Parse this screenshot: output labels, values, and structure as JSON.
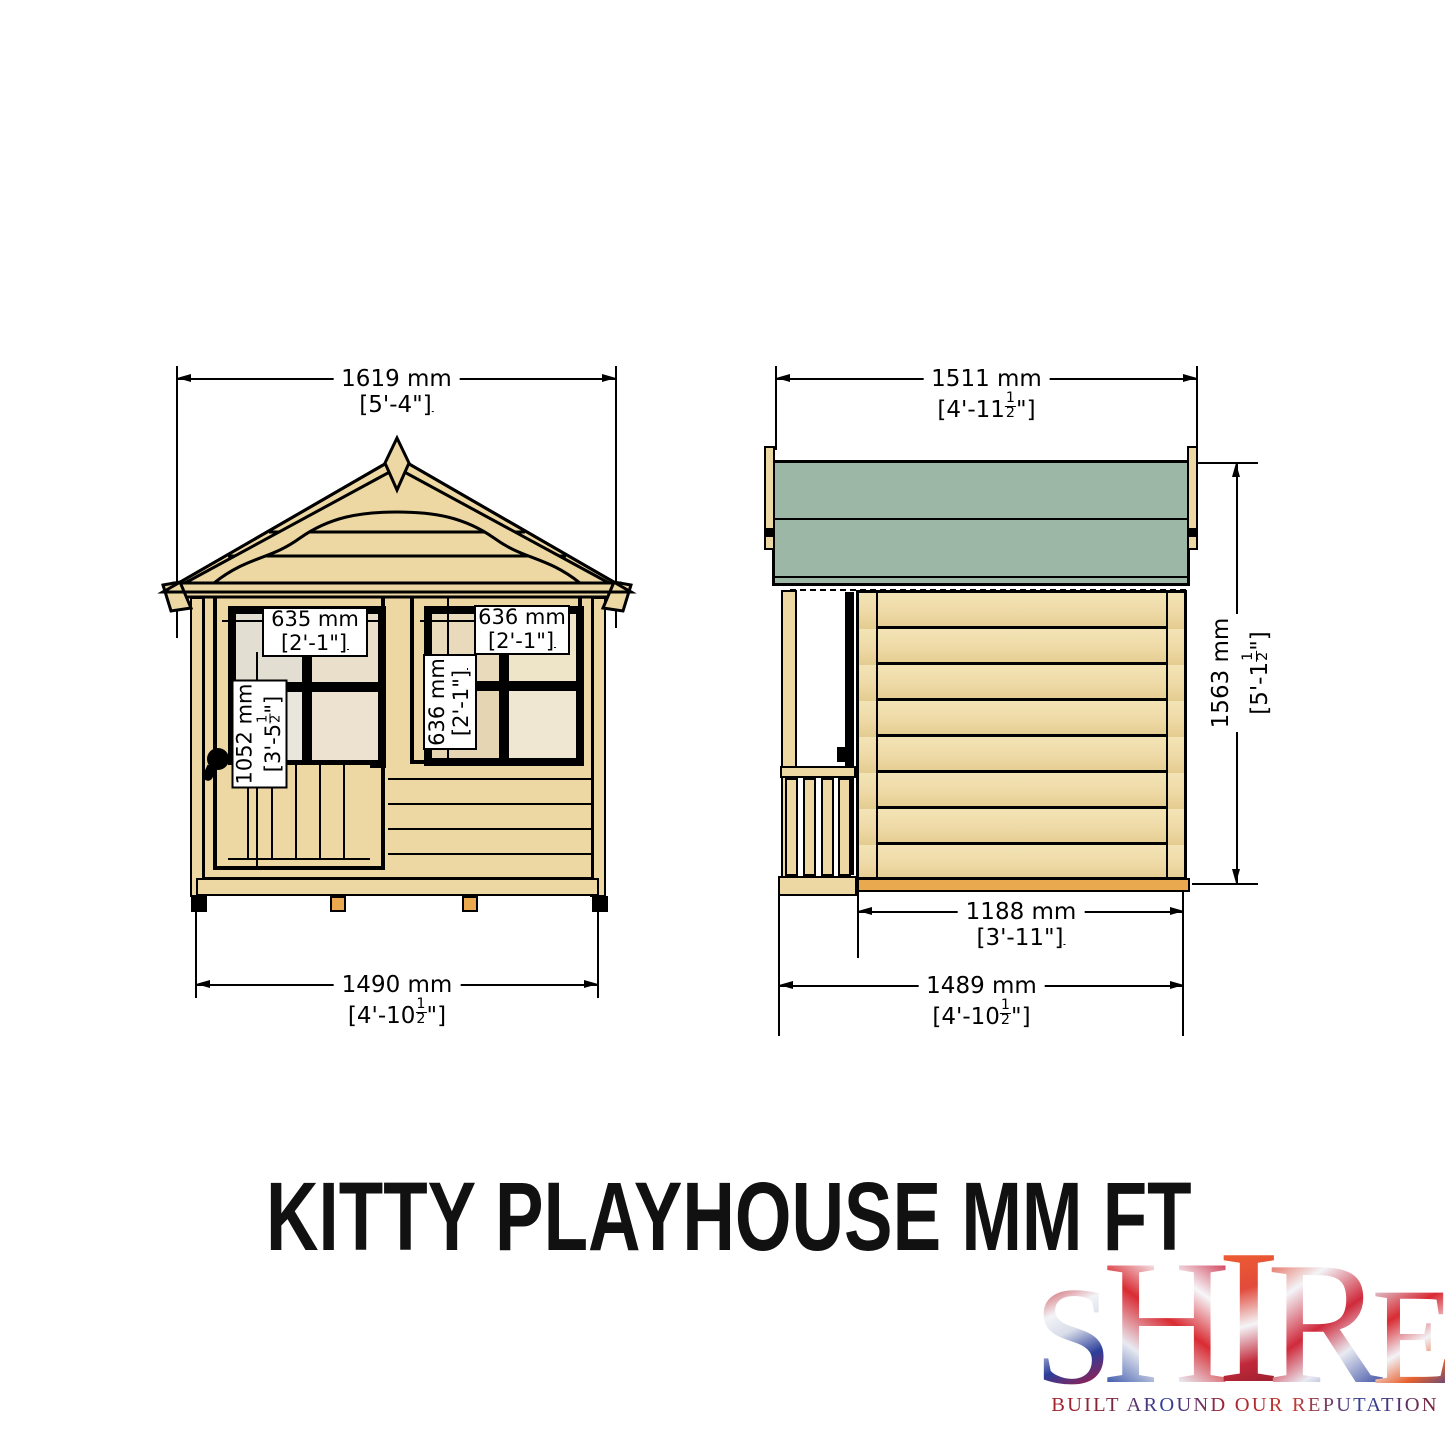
{
  "title": "KITTY PLAYHOUSE MM FT",
  "drawing": {
    "front_view": {
      "label": "front elevation",
      "dims": {
        "overall_width": {
          "mm": "1619 mm",
          "ft_pre": "[5'-4\"]",
          "ft_num": "",
          "ft_den": "",
          "ft_post": ""
        },
        "base_width": {
          "mm": "1490 mm",
          "ft_pre": "[4'-10",
          "ft_num": "1",
          "ft_den": "2",
          "ft_post": "\"]"
        },
        "door_window_width": {
          "mm": "635 mm",
          "ft_pre": "[2'-1\"]",
          "ft_num": "",
          "ft_den": "",
          "ft_post": ""
        },
        "door_height": {
          "mm": "1052 mm",
          "ft_pre": "[3'-5",
          "ft_num": "1",
          "ft_den": "2",
          "ft_post": "\"]"
        },
        "window_width": {
          "mm": "636 mm",
          "ft_pre": "[2'-1\"]",
          "ft_num": "",
          "ft_den": "",
          "ft_post": ""
        },
        "window_height": {
          "mm": "636 mm",
          "ft_pre": "[2'-1\"]",
          "ft_num": "",
          "ft_den": "",
          "ft_post": ""
        }
      }
    },
    "side_view": {
      "label": "side elevation",
      "dims": {
        "overall_depth": {
          "mm": "1511 mm",
          "ft_pre": "[4'-11",
          "ft_num": "1",
          "ft_den": "2",
          "ft_post": "\"]"
        },
        "overall_height": {
          "mm": "1563 mm",
          "ft_pre": "[5'-1",
          "ft_num": "1",
          "ft_den": "2",
          "ft_post": "\"]"
        },
        "wall_depth": {
          "mm": "1188 mm",
          "ft_pre": "[3'-11\"]",
          "ft_num": "",
          "ft_den": "",
          "ft_post": ""
        },
        "base_depth": {
          "mm": "1489 mm",
          "ft_pre": "[4'-10",
          "ft_num": "1",
          "ft_den": "2",
          "ft_post": "\"]"
        }
      }
    }
  },
  "logo": {
    "letters": [
      "S",
      "H",
      "I",
      "R",
      "E"
    ],
    "tagline": "BUILT AROUND OUR REPUTATION"
  },
  "colors": {
    "wood": "#edd7a3",
    "roof_green": "#9db7a7",
    "floor_orange": "#e9a94f",
    "outline": "#000000",
    "label_bg": "#ffffff"
  }
}
